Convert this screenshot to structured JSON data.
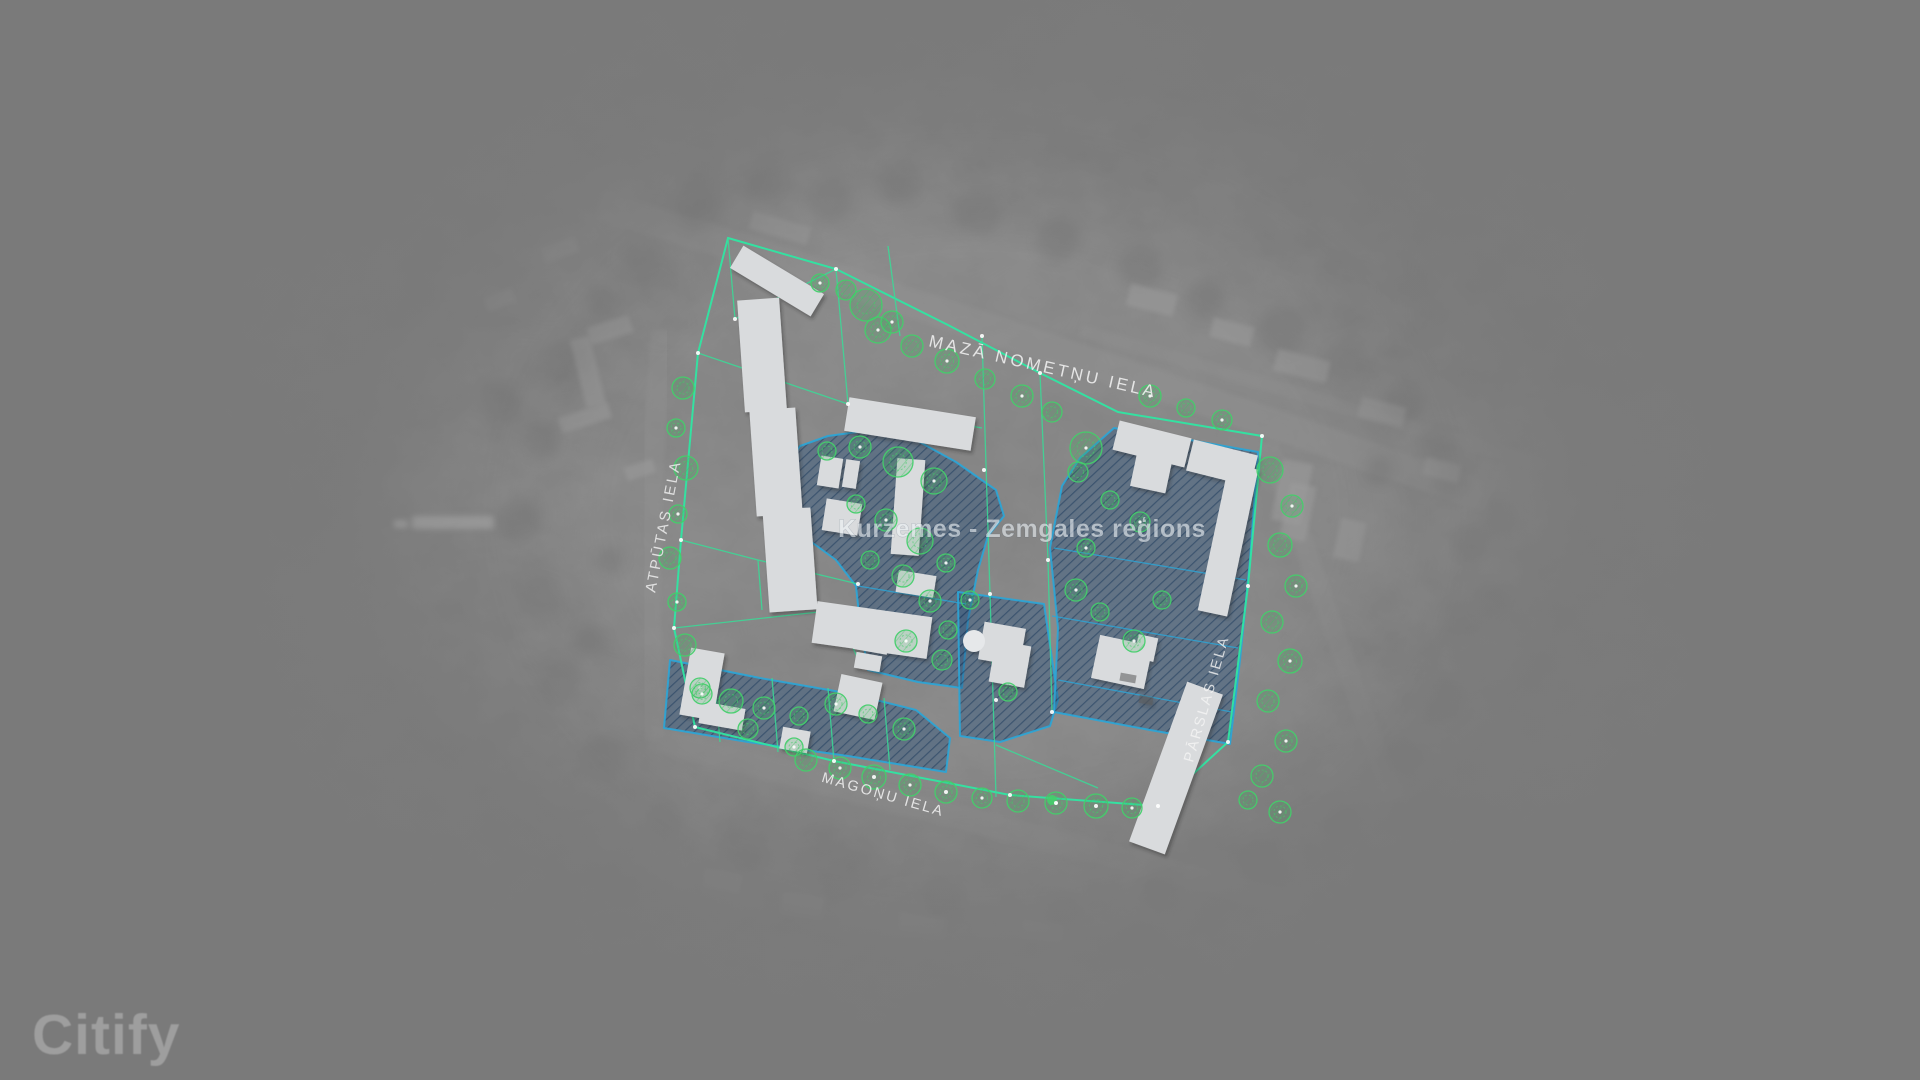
{
  "app": {
    "watermark": "Citify"
  },
  "map": {
    "region_label": "Kurzemes - Zemgales reģions",
    "streets": [
      {
        "id": "maza-nometnu-iela",
        "name": "MAZĀ NOMETŅU IELA"
      },
      {
        "id": "atputas-iela",
        "name": "ATPŪTAS IELA"
      },
      {
        "id": "magonu-iela",
        "name": "MAGOŅU IELA"
      },
      {
        "id": "parslas-iela",
        "name": "PĀRSLAS IELA"
      }
    ],
    "colors": {
      "background": "#7a7a7a",
      "site_boundary": "#2fe6a2",
      "parcel_line": "#38dc96",
      "zone_fill": "#2c547f",
      "zone_border": "#2aa6d8",
      "zone_hatch": "#1d3a5c",
      "tree": "#44cf6b",
      "building": "#d9dbdd",
      "street_label": "#f5f5f5",
      "region_label_color": "#eef3f6"
    }
  }
}
